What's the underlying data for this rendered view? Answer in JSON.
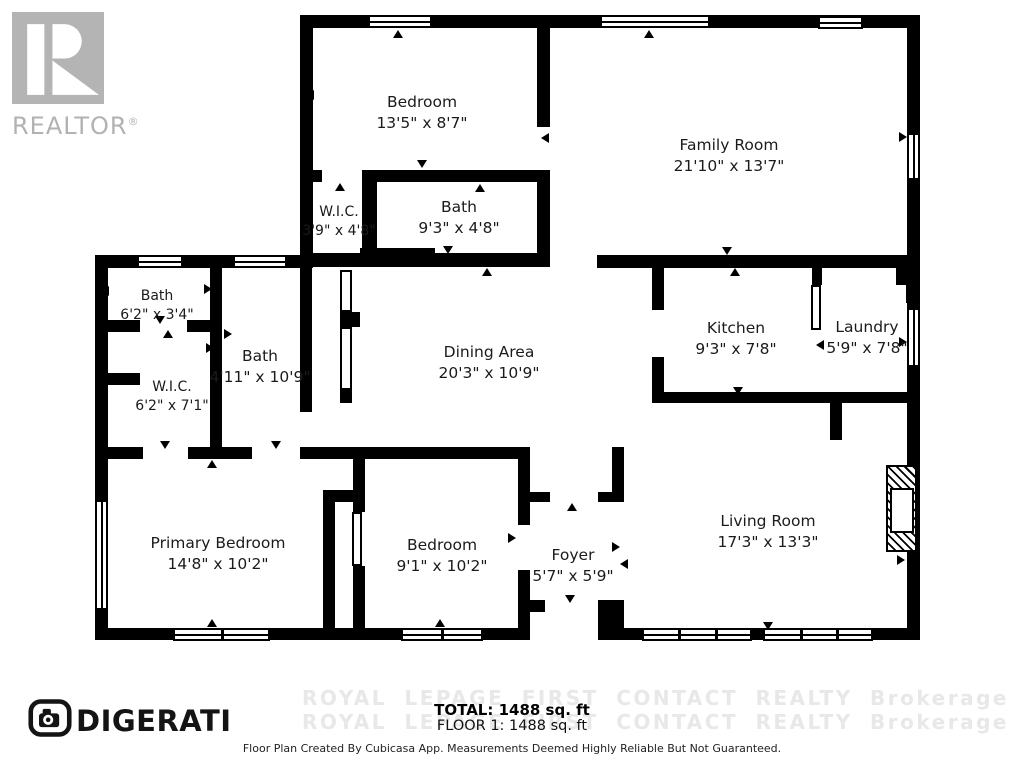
{
  "branding": {
    "realtor_logo_text": "REALTOR",
    "realtor_reg_mark": "®",
    "digerati_text": "DIGERATI"
  },
  "rooms": [
    {
      "name": "Bedroom",
      "dims": "13'5\" x 8'7\""
    },
    {
      "name": "Family Room",
      "dims": "21'10\" x 13'7\""
    },
    {
      "name": "W.I.C.",
      "dims": "3'9\" x 4'8\""
    },
    {
      "name": "Bath",
      "dims": "9'3\" x 4'8\""
    },
    {
      "name": "Bath",
      "dims": "6'2\" x 3'4\""
    },
    {
      "name": "Bath",
      "dims": "4'11\" x 10'9\""
    },
    {
      "name": "W.I.C.",
      "dims": "6'2\" x 7'1\""
    },
    {
      "name": "Dining Area",
      "dims": "20'3\" x 10'9\""
    },
    {
      "name": "Kitchen",
      "dims": "9'3\" x 7'8\""
    },
    {
      "name": "Laundry",
      "dims": "5'9\" x 7'8\""
    },
    {
      "name": "Primary Bedroom",
      "dims": "14'8\" x 10'2\""
    },
    {
      "name": "Bedroom",
      "dims": "9'1\" x 10'2\""
    },
    {
      "name": "Foyer",
      "dims": "5'7\" x 5'9\""
    },
    {
      "name": "Living Room",
      "dims": "17'3\" x 13'3\""
    }
  ],
  "footer": {
    "total": "TOTAL: 1488 sq. ft",
    "floor": "FLOOR 1: 1488 sq. ft",
    "disclaimer": "Floor Plan Created By Cubicasa App. Measurements Deemed Highly Reliable But Not Guaranteed.",
    "watermark": "ROYAL LEPAGE FIRST CONTACT REALTY Brokerage"
  },
  "colors": {
    "wall": "#000000",
    "logo_gray": "#b2b2b2",
    "watermark_gray": "#e8e8e8"
  }
}
